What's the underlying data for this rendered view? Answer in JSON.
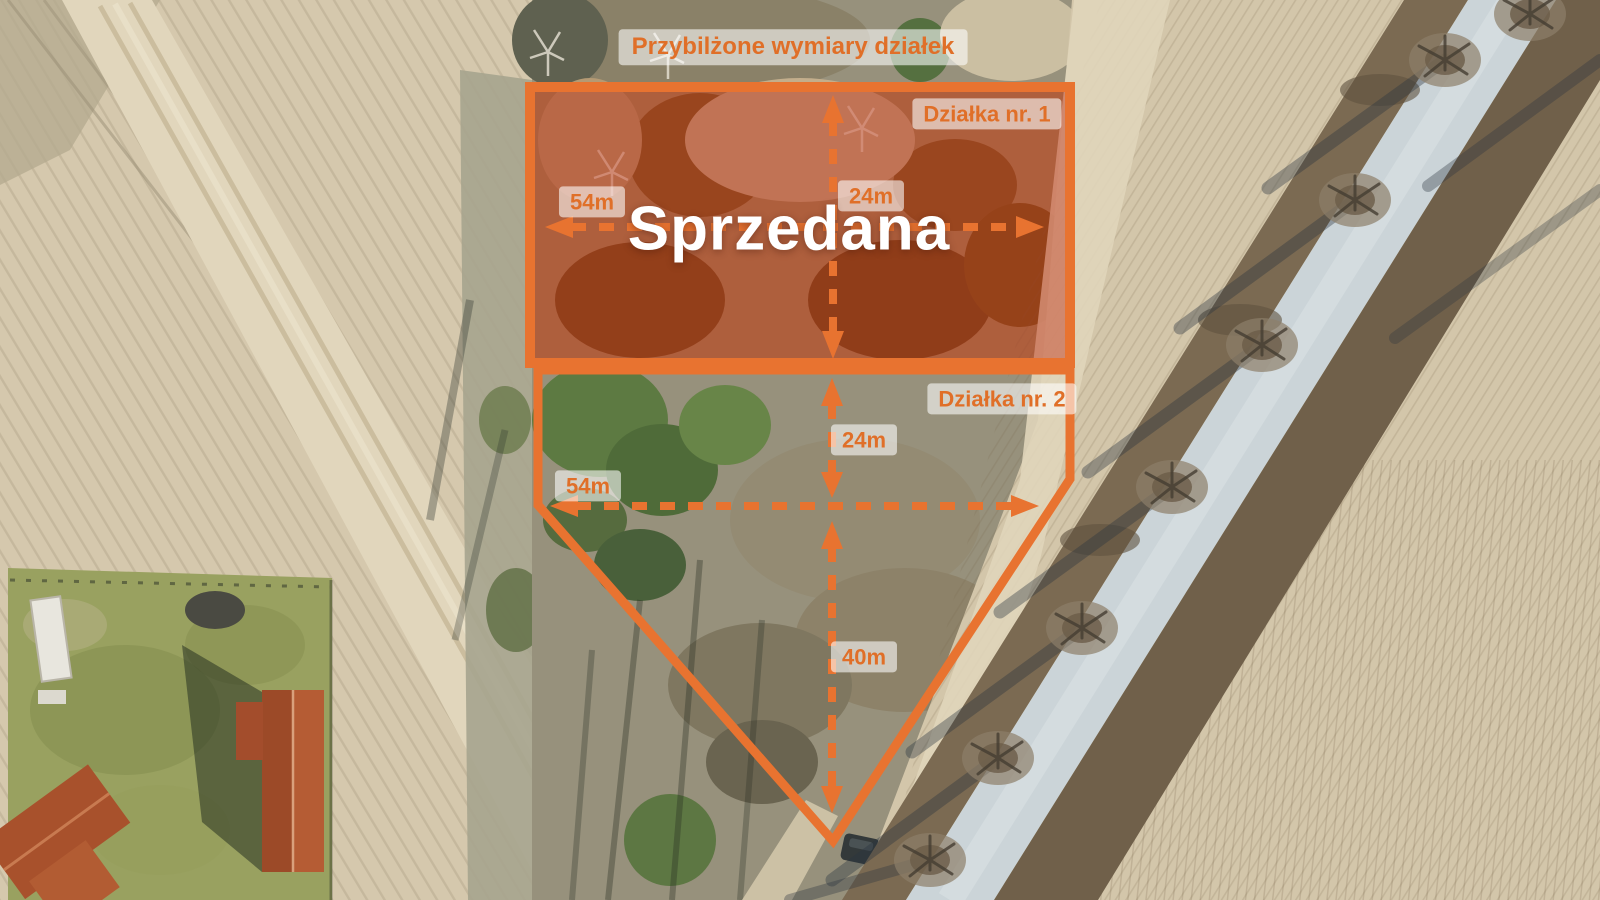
{
  "colors": {
    "accent": "#e87330",
    "label_text": "#e06f28",
    "label_bg": "rgba(255,255,255,0.58)",
    "sold_fill": "rgba(190,45,18,0.45)",
    "sold_text": "#ffffff"
  },
  "annotations": {
    "title": "Przybilżone wymiary działek",
    "plot1": {
      "name": "Działka nr. 1",
      "status": "Sprzedana",
      "width": "54m",
      "depth": "24m"
    },
    "plot2": {
      "name": "Działka nr. 2",
      "width": "54m",
      "depth_upper": "24m",
      "depth_lower": "40m"
    }
  }
}
